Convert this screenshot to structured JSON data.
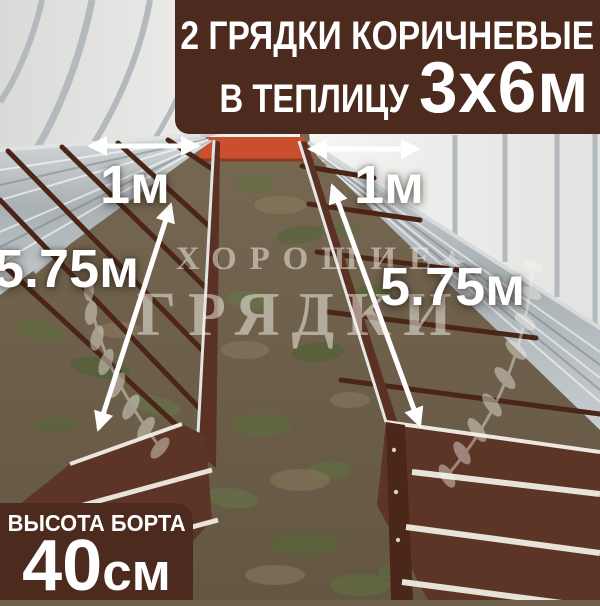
{
  "product_banner": {
    "line1": "2 ГРЯДКИ КОРИЧНЕВЫЕ",
    "line2_prefix": "В ТЕПЛИЦУ",
    "line2_highlight": "3х6м"
  },
  "height_badge": {
    "label": "ВЫСОТА БОРТА",
    "value": "40",
    "unit": "см"
  },
  "dimension_labels": {
    "left_bed_width": "1м",
    "right_bed_width": "1м",
    "left_bed_length": "5.75м",
    "right_bed_length": "5.75м"
  },
  "watermark": {
    "brand_line1": "ХОРОШИЕ",
    "brand_line2": "ГРЯДКИ"
  },
  "scene": {
    "description_items": [
      "greenhouse-interior",
      "two-brown-raised-beds",
      "soil-path",
      "orange-end-panel"
    ]
  },
  "colors": {
    "overlay_brown": "#4c2b1e",
    "bed_brown": "#5d3526",
    "bed_dark_brown": "#4b2517",
    "galvanized_silver": "#b7bec2",
    "orange_end_panel": "#c94f2e",
    "arrow_white": "#ffffff",
    "watermark_white": "rgba(248,245,236,0.5)"
  }
}
